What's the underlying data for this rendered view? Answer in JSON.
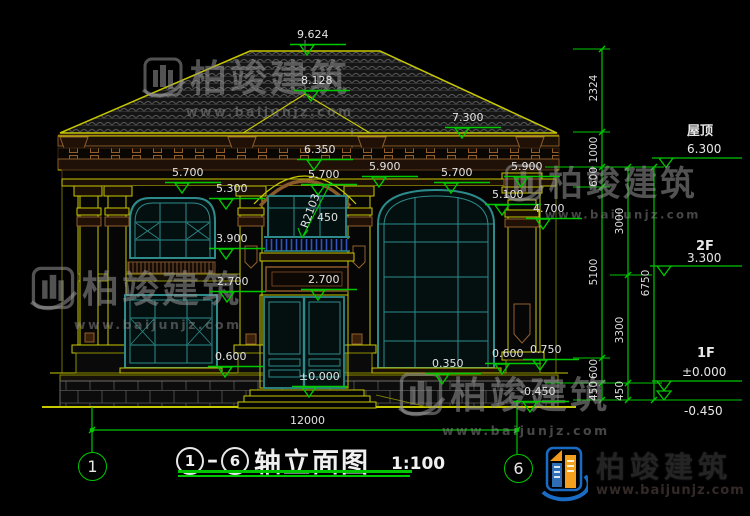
{
  "title": {
    "axis_from": "1",
    "axis_to": "6",
    "name": "轴立面图",
    "scale": "1:100"
  },
  "axis_bubbles": {
    "left": "1",
    "right": "6"
  },
  "watermark": {
    "brand": "柏竣建筑",
    "url": "www.baijunjz.com"
  },
  "logo": {
    "brand": "柏竣建筑",
    "url": "www.baijunjz.com"
  },
  "levels": [
    {
      "name": "屋顶",
      "value": "6.300"
    },
    {
      "name": "2F",
      "value": "3.300"
    },
    {
      "name": "1F",
      "value": "±0.000"
    },
    {
      "name": "",
      "value": "-0.450"
    }
  ],
  "elevation_labels": [
    {
      "text": "9.624",
      "x": 297,
      "y": 29,
      "marker": true
    },
    {
      "text": "8.128",
      "x": 301,
      "y": 75,
      "marker": true
    },
    {
      "text": "7.300",
      "x": 452,
      "y": 112,
      "marker": true
    },
    {
      "text": "6.350",
      "x": 304,
      "y": 144,
      "marker": true
    },
    {
      "text": "5.700",
      "x": 172,
      "y": 167,
      "marker": true
    },
    {
      "text": "5.700",
      "x": 308,
      "y": 169,
      "marker": true
    },
    {
      "text": "5.700",
      "x": 441,
      "y": 167,
      "marker": true
    },
    {
      "text": "5.900",
      "x": 369,
      "y": 161,
      "marker": true
    },
    {
      "text": "5.900",
      "x": 511,
      "y": 161,
      "marker": true
    },
    {
      "text": "5.300",
      "x": 216,
      "y": 183,
      "marker": true
    },
    {
      "text": "5.100",
      "x": 492,
      "y": 189,
      "marker": true
    },
    {
      "text": "4.700",
      "x": 533,
      "y": 203,
      "marker": true
    },
    {
      "text": "3.900",
      "x": 216,
      "y": 233,
      "marker": true
    },
    {
      "text": "450",
      "x": 317,
      "y": 212,
      "marker": false
    },
    {
      "text": "R2103",
      "x": 293,
      "y": 205,
      "marker": false,
      "rotate": -70
    },
    {
      "text": "2.700",
      "x": 217,
      "y": 276,
      "marker": true
    },
    {
      "text": "2.700",
      "x": 308,
      "y": 274,
      "marker": true
    },
    {
      "text": "0.600",
      "x": 215,
      "y": 351,
      "marker": true
    },
    {
      "text": "0.600",
      "x": 492,
      "y": 348,
      "marker": true
    },
    {
      "text": "0.350",
      "x": 432,
      "y": 358,
      "marker": true
    },
    {
      "text": "0.750",
      "x": 530,
      "y": 344,
      "marker": true
    },
    {
      "text": "±0.000",
      "x": 299,
      "y": 371,
      "marker": true
    },
    {
      "text": "-0.450",
      "x": 520,
      "y": 386,
      "marker": true
    },
    {
      "text": "12000",
      "x": 290,
      "y": 415,
      "marker": false
    }
  ],
  "chain_labels": [
    {
      "text": "2324",
      "x": 594,
      "y": 88
    },
    {
      "text": "1000",
      "x": 594,
      "y": 150
    },
    {
      "text": "600",
      "x": 594,
      "y": 177
    },
    {
      "text": "5100",
      "x": 594,
      "y": 272
    },
    {
      "text": "600",
      "x": 594,
      "y": 369
    },
    {
      "text": "450",
      "x": 594,
      "y": 391
    },
    {
      "text": "3000",
      "x": 620,
      "y": 221
    },
    {
      "text": "3300",
      "x": 620,
      "y": 330
    },
    {
      "text": "450",
      "x": 620,
      "y": 391
    },
    {
      "text": "6750",
      "x": 646,
      "y": 283
    }
  ],
  "colors": {
    "line_yellow": "#c8c800",
    "dim_green": "#00c800",
    "window_teal": "#2e8b8b",
    "trim_brown": "#915f2c",
    "baluster_blue": "#3355bb",
    "text_white": "#e2e2e2",
    "logo_blue": "#1a6bc4",
    "logo_orange": "#f2991e"
  }
}
